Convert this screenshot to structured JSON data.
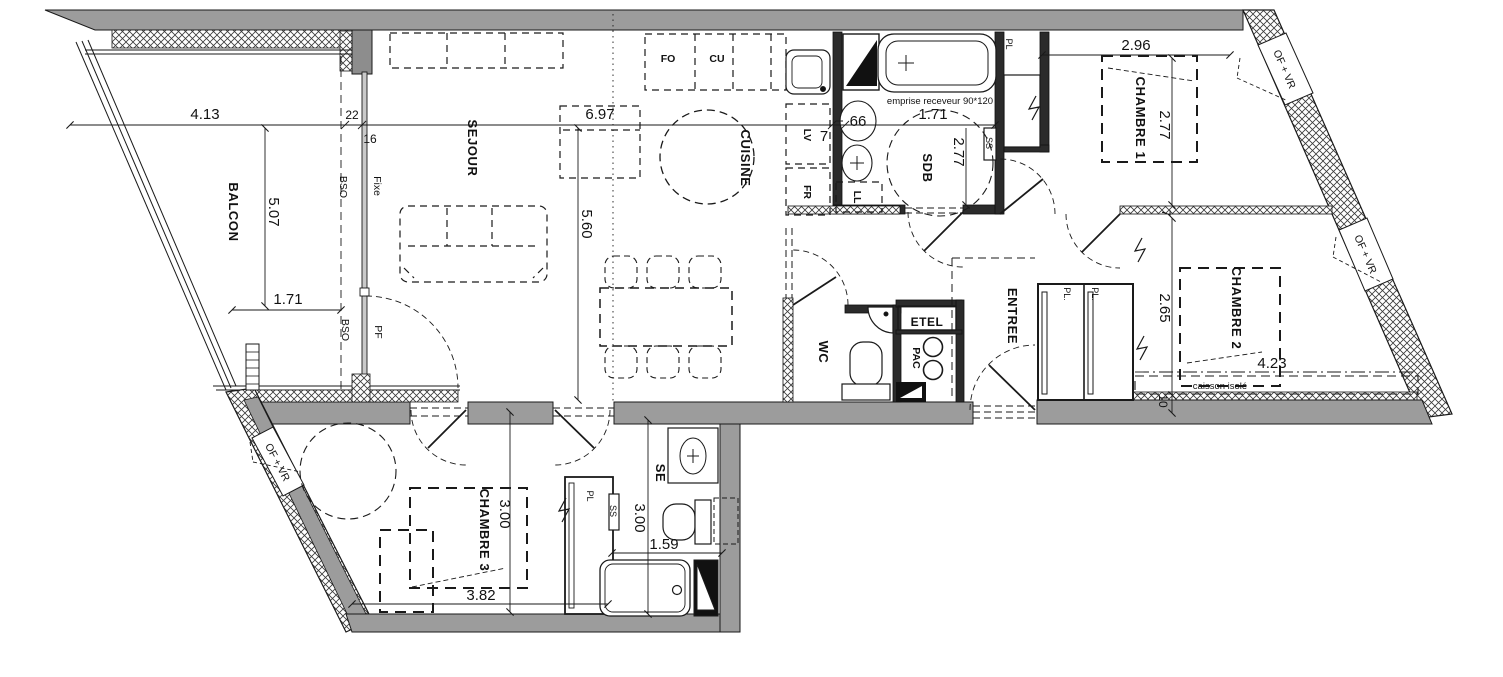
{
  "plan": {
    "rooms": {
      "balcon": "BALCON",
      "sejour": "SEJOUR",
      "cuisine": "CUISINE",
      "sdb": "SDB",
      "chambre1": "CHAMBRE 1",
      "chambre2": "CHAMBRE 2",
      "chambre3": "CHAMBRE 3",
      "entree": "ENTREE",
      "wc": "WC",
      "se": "SE"
    },
    "dimensions": {
      "balcon_width": "4.13",
      "balcon_depth": "5.07",
      "balcon_inner": "1.71",
      "wall_22": "22",
      "wall_16": "16",
      "sejour_width": "6.97",
      "sejour_depth": "5.60",
      "cuisine_wall": "7",
      "basin_66": "66",
      "sdb_width": "1.71",
      "sdb_depth": "2.77",
      "ch1_width": "2.96",
      "ch1_depth": "2.77",
      "ch1_wall": "7",
      "ch2_depth": "2.65",
      "ch2_width": "4.23",
      "ch2_wall": "10",
      "ch3_depth": "3.00",
      "ch3_width": "3.82",
      "se_depth": "3.00",
      "se_width": "1.59"
    },
    "annotations": {
      "emprise": "emprise receveur 90*120",
      "caisson": "caisson isolé",
      "bso_a": "BSO",
      "bso_b": "BSO",
      "fixe": "Fixe",
      "pf": "PF",
      "of_vr_1": "OF + VR",
      "of_vr_2": "OF + VR",
      "of_vr_3": "OF + VR",
      "ss_sdb": "SS",
      "ss_se": "SS",
      "pl_ch1": "PL",
      "pl_entree_1": "PL.",
      "pl_entree_2": "PL.",
      "pl_se": "PL"
    },
    "equipment": {
      "fo": "FO",
      "cu": "CU",
      "lv": "LV",
      "fr": "FR",
      "ll": "LL",
      "etel": "ETEL",
      "pac": "PAC"
    }
  }
}
